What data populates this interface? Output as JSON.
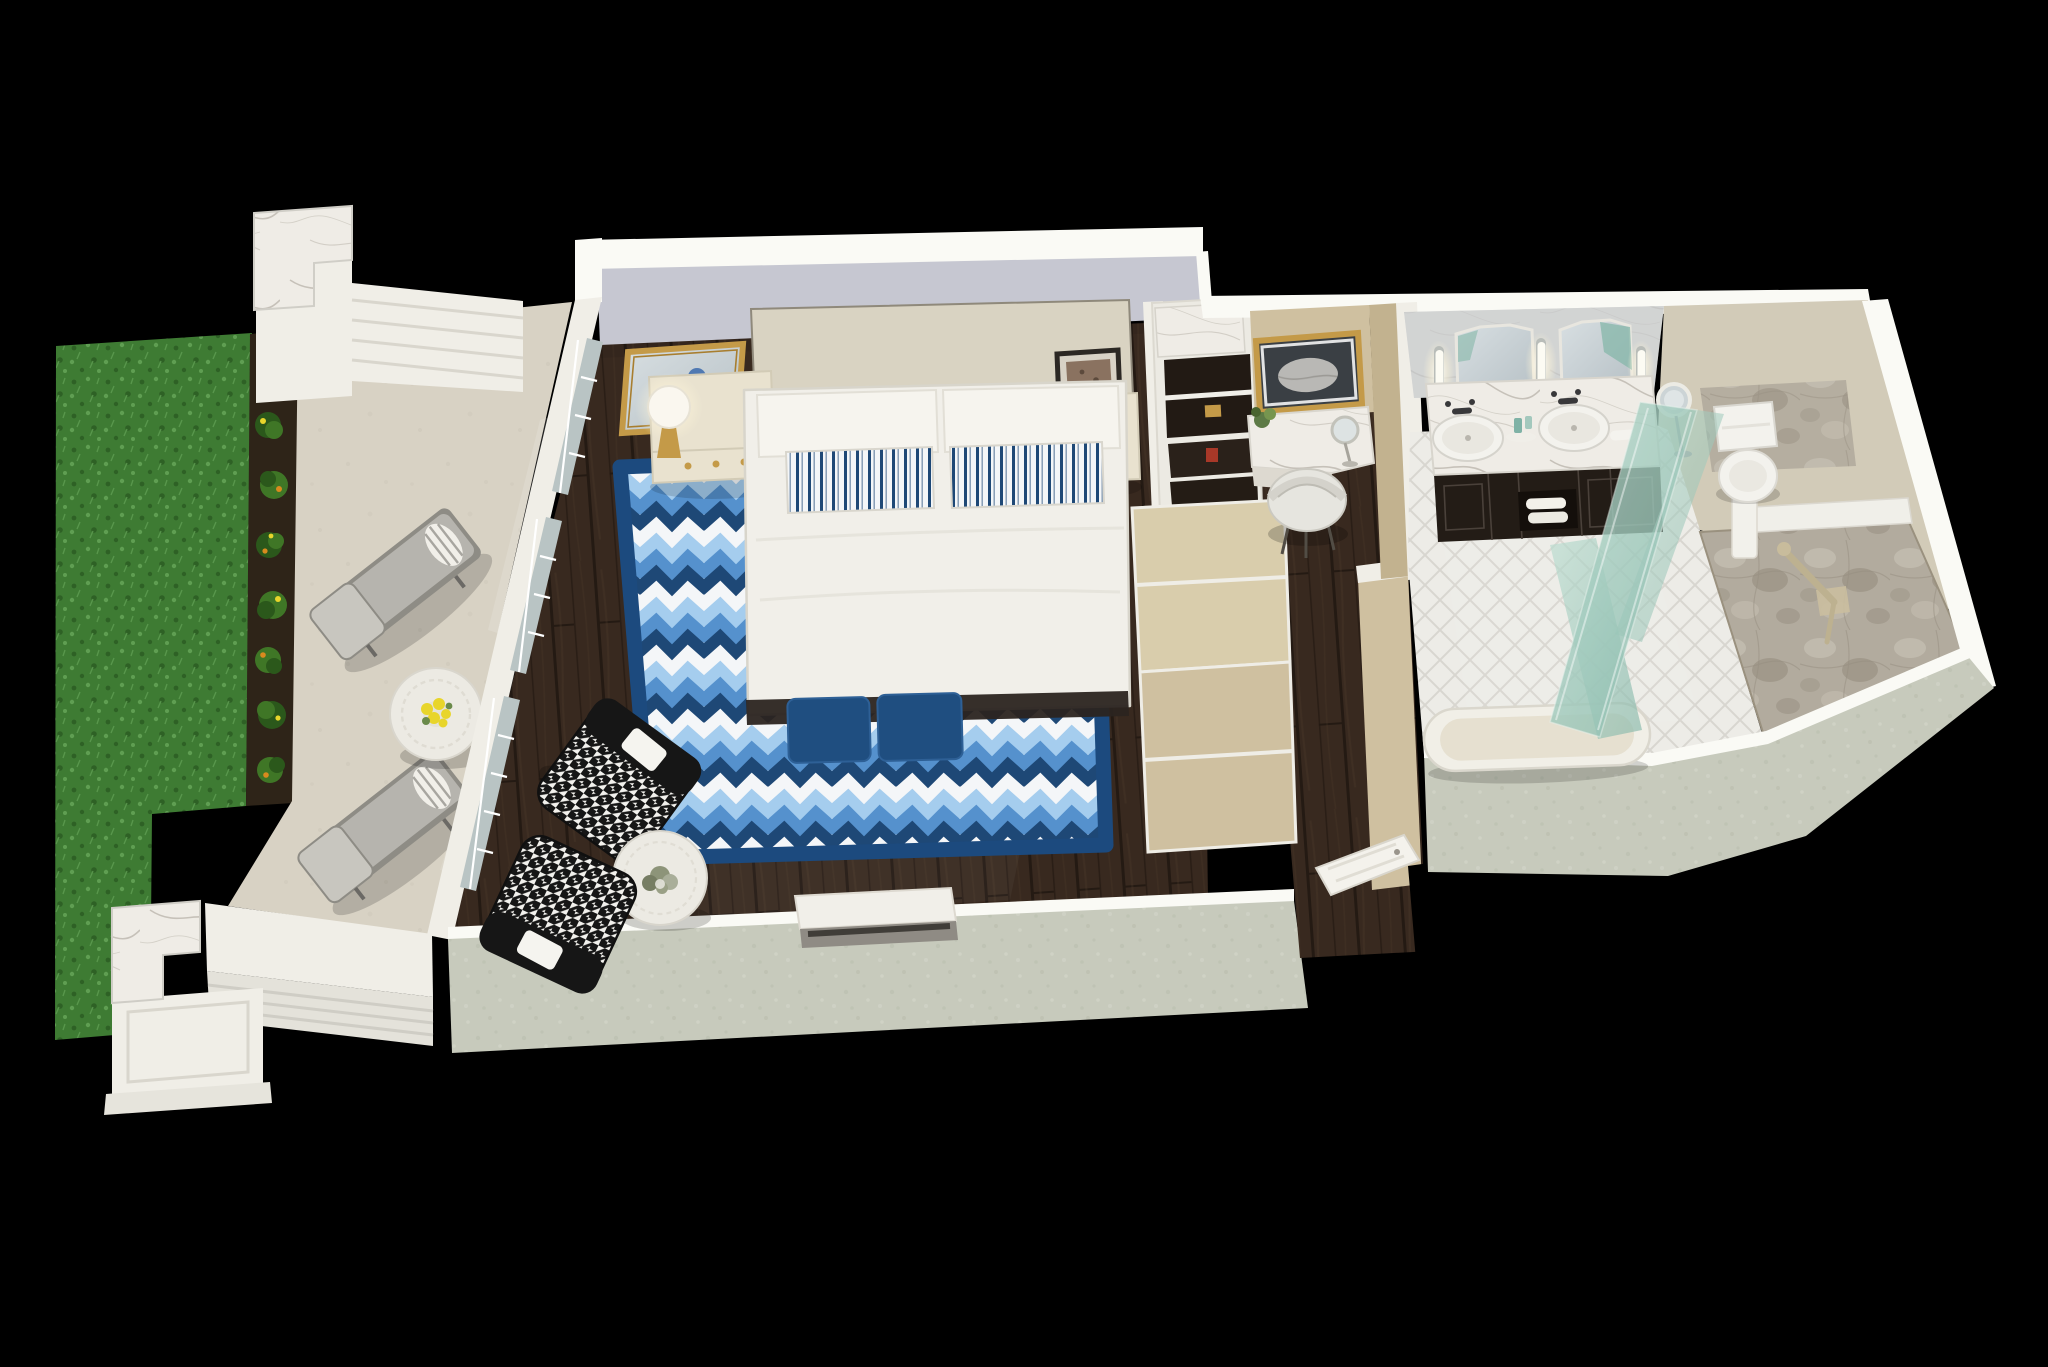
{
  "scene": {
    "type": "3d-floorplan-render",
    "style": "isometric dollhouse cutaway of a hotel guest suite",
    "background": "#000000"
  },
  "rooms": [
    {
      "id": "patio",
      "label": "private-patio",
      "furniture": [
        "grass-lawn",
        "flower-planter",
        "privacy-wall-pillars",
        "chaise-lounge x2",
        "round-lattice-side-table with yellow flowers",
        "low-garden-wall"
      ]
    },
    {
      "id": "bedroom",
      "label": "bedroom",
      "furniture": [
        "king-bed with striped pillows",
        "chevron-area-rug",
        "nightstand x2",
        "gold-wall-mirror",
        "table-lamp x2",
        "framed-artwork",
        "navy-ottoman x2",
        "houndstooth-armchair x2",
        "round-accent-table with plant",
        "media-console",
        "french-window-wall"
      ]
    },
    {
      "id": "closet",
      "label": "closet-wardrobe",
      "furniture": [
        "open-shelving with marble top",
        "lower-cabinets"
      ]
    },
    {
      "id": "vanity-nook",
      "label": "makeup-vanity-nook",
      "furniture": [
        "lighted-gold-mirror",
        "marble-vanity-counter",
        "vanity-stool",
        "magnifying-mirror",
        "potted-plant"
      ]
    },
    {
      "id": "hallway",
      "label": "entry-hallway",
      "furniture": [
        "entry-door",
        "wood-floor"
      ]
    },
    {
      "id": "bathroom",
      "label": "bathroom",
      "furniture": [
        "double-vanity marble top",
        "octagonal-mirror x2",
        "sconce-light x3",
        "vessel-sink x2",
        "espresso-cabinet with towels",
        "freestanding-tub",
        "teal-glass-shower-enclosure",
        "stone-walk-in-shower",
        "grab-bar with hand shower",
        "toilet",
        "magnifying-mirror-stand",
        "herringbone-tile-floor"
      ]
    }
  ],
  "palette": {
    "black": "#000000",
    "wallWhite": "#f0eee7",
    "wallBright": "#fafaf5",
    "wallShadow": "#d9d6cd",
    "lavender": "#c6c7d1",
    "khaki": "#cfc0a0",
    "khakiLight": "#d9cdac",
    "khakiDark": "#c2b28f",
    "sage": "#c7cabc",
    "sageDot": "#b7bcab",
    "sageDot2": "#d5d7cb",
    "woodBase": "#38291f",
    "woodLine": "#241a13",
    "woodStreak": "#54402f",
    "grassBase": "#3e7b33",
    "grassDark": "#2e6125",
    "grassLight": "#5f9e52",
    "soil": "#2e2418",
    "shrub": "#3f7626",
    "shrubDark": "#2b581b",
    "flowerOrange": "#d98a1e",
    "flowerYellow": "#e8d52b",
    "concrete": "#d8d2c4",
    "concreteDot": "#c8c2b3",
    "chaiseFrame": "#8e8c85",
    "chaiseCushion": "#b6b4ae",
    "chaiseCushionLight": "#c8c6bf",
    "tableWhite": "#eceae3",
    "rugNavy": "#1e4876",
    "rugWhite": "#f4f6f8",
    "rugSky": "#a5cdee",
    "rugMedium": "#5591cd",
    "rugBorder": "#1c4a7e",
    "bedWhite": "#f1efe9",
    "bedShadow": "#d8d5cb",
    "headboard": "#d9d3c2",
    "bedFrame": "#2b2420",
    "ottoman": "#1f4e80",
    "ottomanLight": "#2e6096",
    "houndBlack": "#161616",
    "houndWhite": "#f2f1ed",
    "cream": "#e9e2cf",
    "creamLine": "#d2cbb6",
    "gold": "#c49a48",
    "goldDeep": "#a87e2f",
    "mirrorA": "#d8dfe2",
    "mirrorB": "#b6c0c5",
    "glassWin": "#b9c4c4",
    "espresso": "#231c16",
    "espressoLine": "#4a413a",
    "marbleBase": "#efece6",
    "marbleVein": "#b5afa5",
    "herringBase": "#edece7",
    "herringLine": "#d8d6d0",
    "stoneBase": "#b2ab9e",
    "stoneLight": "#c7c1b4",
    "stoneDark": "#968e7f",
    "teal1": "#b9dccf",
    "teal2": "#85b7a9",
    "toilet": "#f3f2ed",
    "lampBlue": "#3a6ca8",
    "artBrown": "#8a7260",
    "frameDark": "#2c2824"
  }
}
